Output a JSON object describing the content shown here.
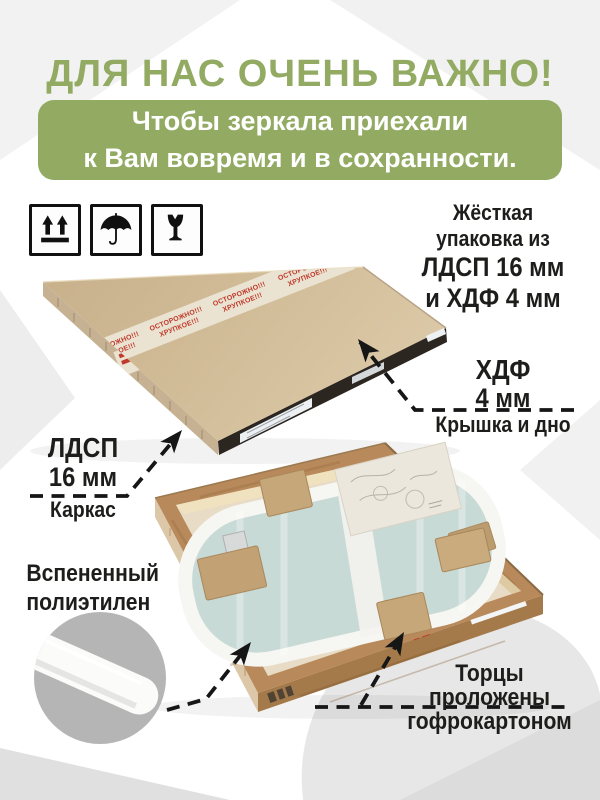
{
  "header": {
    "title": "ДЛЯ НАС ОЧЕНЬ ВАЖНО!"
  },
  "banner": {
    "line1": "Чтобы зеркала приехали",
    "line2": "к Вам вовремя и в сохранности."
  },
  "handling_icons": [
    {
      "name": "this-side-up"
    },
    {
      "name": "keep-dry"
    },
    {
      "name": "fragile"
    }
  ],
  "annotations": {
    "rigid_packaging": {
      "line1": "Жёсткая",
      "line2": "упаковка из",
      "line3": "ЛДСП 16 мм",
      "line4": "и ХДФ 4 мм"
    },
    "hdf": {
      "title": "ХДФ",
      "size": "4 мм",
      "caption": "Крышка и дно"
    },
    "ldsp": {
      "title": "ЛДСП",
      "size": "16 мм",
      "caption": "Каркас"
    },
    "foam": {
      "line1": "Вспененный",
      "line2": "полиэтилен"
    },
    "edges": {
      "line1": "Торцы",
      "line2": "проложены",
      "line3": "гофрокартоном"
    }
  },
  "photos": {
    "closed_box": {
      "tape_word1": "ОСТОРОЖНО!!!",
      "tape_word2": "ХРУПКОЕ!!!"
    }
  },
  "colors": {
    "accent_green": "#92aa62",
    "text_dark": "#1d1d1b",
    "tape_red": "#c03a2c",
    "kraft": "#cdb792",
    "wood": "#b8895a",
    "mirror_film": "#c8dad6"
  }
}
